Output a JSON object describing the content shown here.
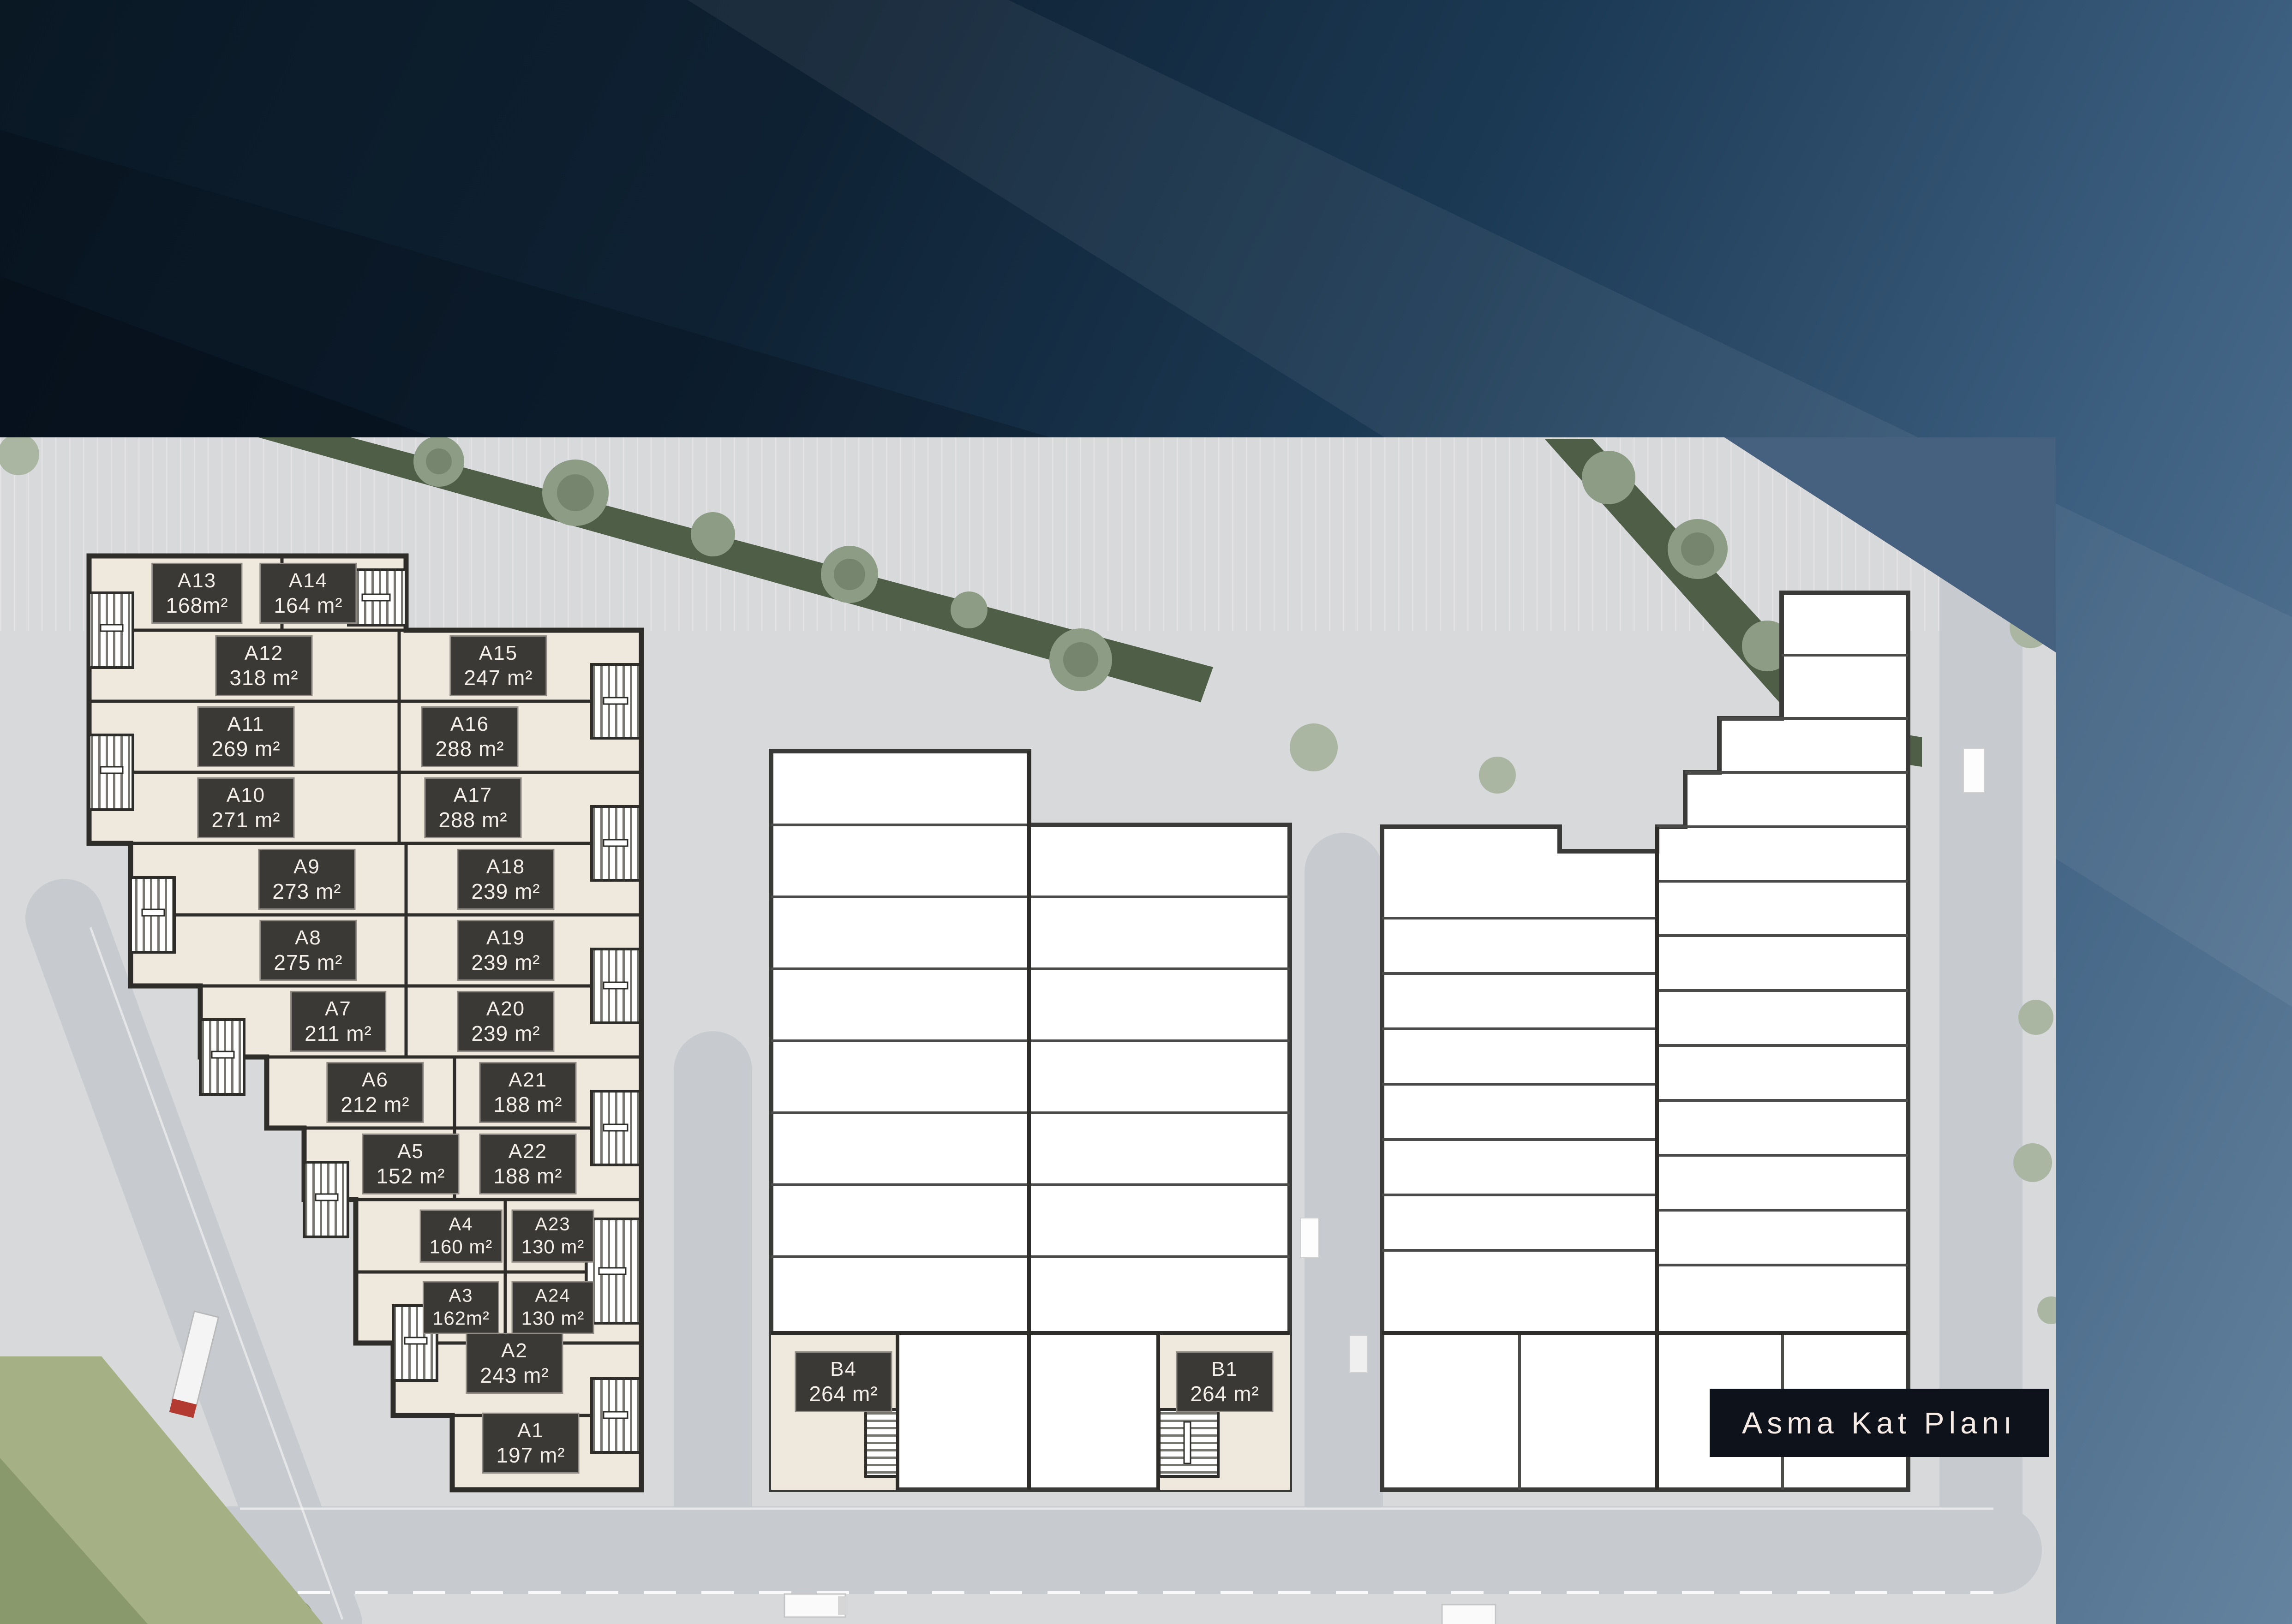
{
  "site_plan": {
    "title_badge": "Asma Kat Planı",
    "units": [
      {
        "name": "A13",
        "area": "168m²"
      },
      {
        "name": "A14",
        "area": "164 m²"
      },
      {
        "name": "A12",
        "area": "318 m²"
      },
      {
        "name": "A15",
        "area": "247 m²"
      },
      {
        "name": "A11",
        "area": "269 m²"
      },
      {
        "name": "A16",
        "area": "288 m²"
      },
      {
        "name": "A10",
        "area": "271 m²"
      },
      {
        "name": "A17",
        "area": "288 m²"
      },
      {
        "name": "A9",
        "area": "273 m²"
      },
      {
        "name": "A18",
        "area": "239 m²"
      },
      {
        "name": "A8",
        "area": "275 m²"
      },
      {
        "name": "A19",
        "area": "239 m²"
      },
      {
        "name": "A7",
        "area": "211 m²"
      },
      {
        "name": "A20",
        "area": "239 m²"
      },
      {
        "name": "A6",
        "area": "212 m²"
      },
      {
        "name": "A21",
        "area": "188 m²"
      },
      {
        "name": "A5",
        "area": "152 m²"
      },
      {
        "name": "A22",
        "area": "188 m²"
      },
      {
        "name": "A4",
        "area": "160 m²"
      },
      {
        "name": "A23",
        "area": "130 m²"
      },
      {
        "name": "A3",
        "area": "162m²"
      },
      {
        "name": "A24",
        "area": "130 m²"
      },
      {
        "name": "A2",
        "area": "243 m²"
      },
      {
        "name": "A1",
        "area": "197 m²"
      },
      {
        "name": "B4",
        "area": "264 m²"
      },
      {
        "name": "B1",
        "area": "264 m²"
      }
    ],
    "colors": {
      "unit_fill": "#efe8dc",
      "wall": "#2e2d2a",
      "chip_bg": "#3b3936",
      "chip_text": "#f3efe8",
      "render_bg": "#d8d9db",
      "badge_bg": "#0e131b",
      "badge_text": "#f6eae4",
      "hero_blue_dark": "#0a1824",
      "hero_blue_light": "#64839f",
      "greenery": "#4f5e46"
    }
  }
}
